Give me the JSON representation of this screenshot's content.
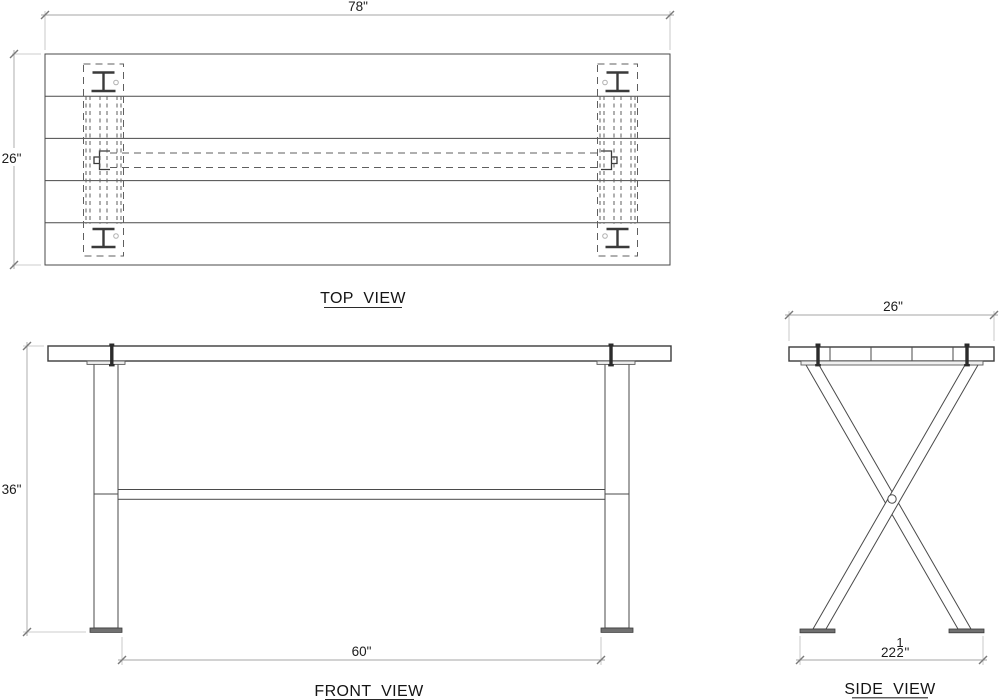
{
  "labels": {
    "top": "TOP VIEW",
    "front": "FRONT VIEW",
    "side": "SIDE VIEW"
  },
  "dims": {
    "top_width": "78\"",
    "top_depth": "26\"",
    "front_height": "36\"",
    "front_foot_span": "60\"",
    "side_width": "26\"",
    "side_foot_span_whole": "22",
    "side_foot_span_num": "1",
    "side_foot_span_den": "2",
    "side_foot_span_unit": "\""
  }
}
